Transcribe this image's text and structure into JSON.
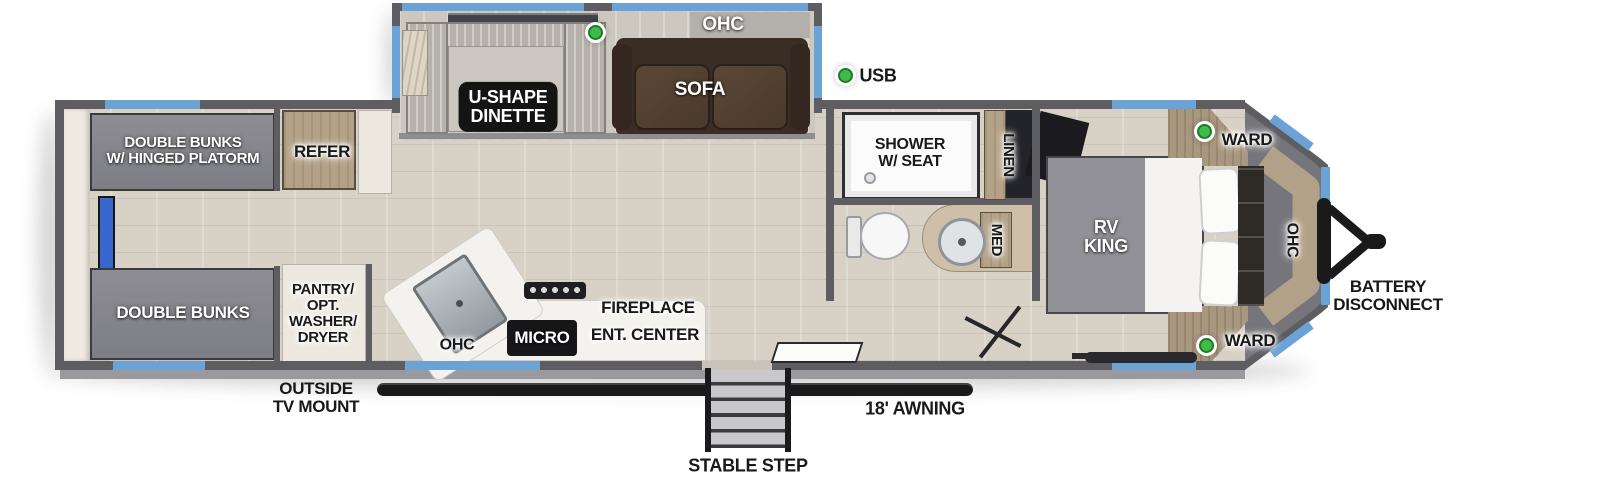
{
  "title": "Travel trailer floor plan",
  "colors": {
    "window_blue": "#6ba3d6",
    "wall_gray": "#5d5d62",
    "green_indicator": "#3fbb4a",
    "floor_beige": "#d8d1c6",
    "awning_black": "#191919"
  },
  "legend": {
    "usb_label": "USB"
  },
  "slideout": {
    "ohc_label": "OHC",
    "sofa_label": "SOFA",
    "dinette_label": "U-SHAPE\nDINETTE"
  },
  "rear": {
    "bunks_top_label": "DOUBLE BUNKS\nW/ HINGED PLATORM",
    "bunks_bottom_label": "DOUBLE BUNKS",
    "refer_label": "REFER",
    "pantry_label": "PANTRY/\nOPT.\nWASHER/\nDRYER",
    "outside_tv_label": "OUTSIDE\nTV MOUNT"
  },
  "kitchen": {
    "ohc_label": "OHC",
    "micro_label": "MICRO",
    "fireplace_label": "FIREPLACE",
    "ent_center_label": "ENT. CENTER"
  },
  "bathroom": {
    "shower_label": "SHOWER\nW/ SEAT",
    "linen_label": "LINEN",
    "med_label": "MED"
  },
  "bedroom": {
    "bed_label": "RV\nKING",
    "ward_top_label": "WARD",
    "ward_bottom_label": "WARD",
    "ohc_label": "OHC"
  },
  "exterior": {
    "battery_label": "BATTERY\nDISCONNECT",
    "awning_label": "18' AWNING",
    "step_label": "STABLE STEP"
  }
}
